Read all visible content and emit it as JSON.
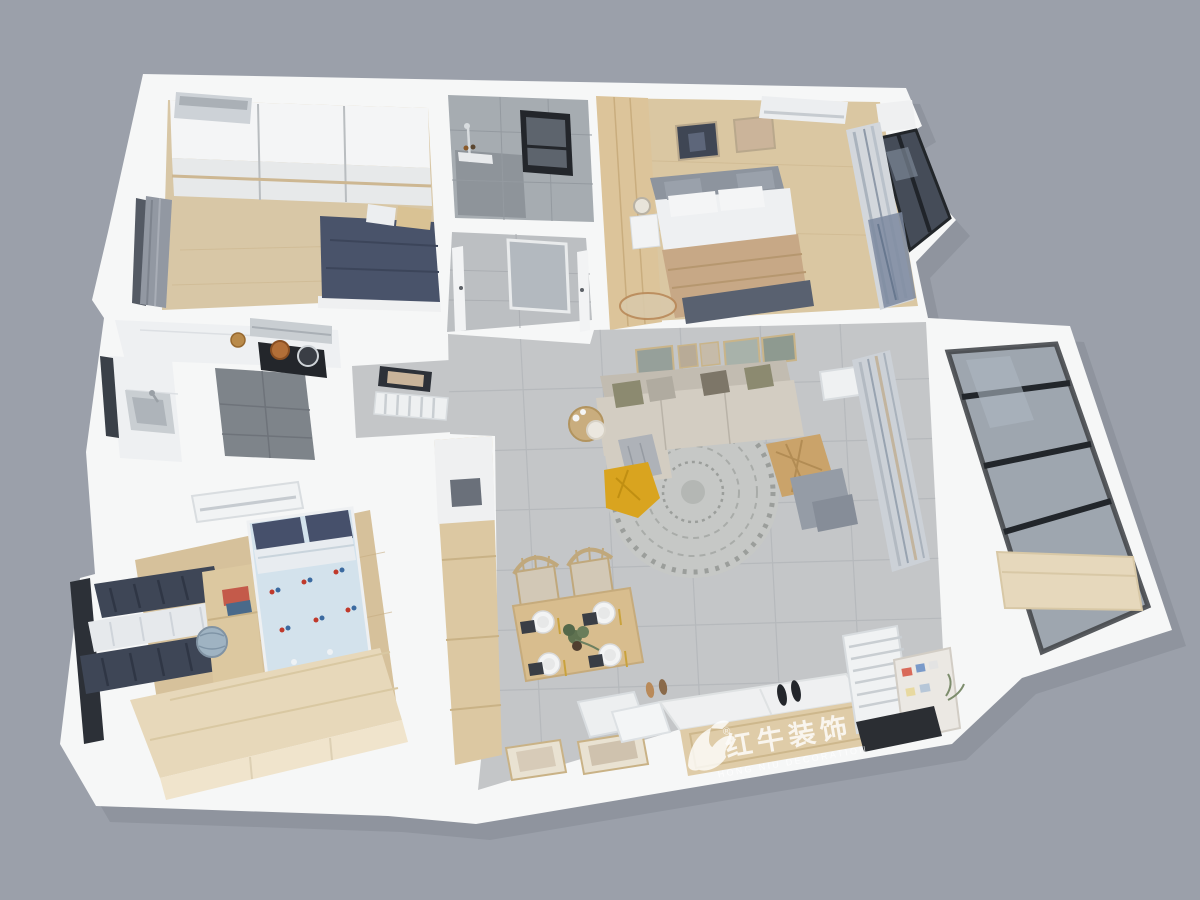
{
  "watermark": {
    "logo": "bull-logo-icon",
    "registered_mark": "®",
    "brand_cn": "红牛装饰",
    "brand_en": "HONG NIU DECORATION"
  },
  "scene": {
    "type": "3d-floor-plan-render",
    "view": "isometric-top-down-dollhouse",
    "rooms": [
      {
        "name": "secondary-bedroom",
        "position": "top-left",
        "items": [
          "sliding-wardrobe",
          "air-conditioner",
          "bed-navy-duvet",
          "gray-curtain-window"
        ]
      },
      {
        "name": "bathroom",
        "position": "top-center",
        "items": [
          "gray-wall-tiles",
          "shower-set",
          "black-framed-window"
        ]
      },
      {
        "name": "master-bedroom",
        "position": "top-right",
        "items": [
          "wood-wardrobe",
          "bed-beige-bedding",
          "two-wall-artworks",
          "air-conditioner",
          "nightstand-lamp",
          "striped-curtains",
          "corner-window"
        ]
      },
      {
        "name": "hallway",
        "position": "center-top",
        "items": [
          "frosted-glass-door",
          "white-interior-doors"
        ]
      },
      {
        "name": "kitchen",
        "position": "middle-left",
        "items": [
          "marble-counters",
          "range-hood",
          "gas-stove",
          "copper-pot",
          "sink",
          "side-window"
        ]
      },
      {
        "name": "living-dining-area",
        "position": "center",
        "items": [
          "fabric-sofa",
          "throw-pillows",
          "gallery-wall-frames",
          "round-mandala-rug",
          "yellow-beanbag",
          "rattan-armchair",
          "side-table-lamp",
          "air-conditioner",
          "striped-curtains",
          "dining-table-four-settings",
          "windsor-chairs",
          "plant-centerpiece"
        ]
      },
      {
        "name": "kids-bedroom",
        "position": "bottom-left",
        "items": [
          "bed-airplane-print-bedding",
          "navy-curtains",
          "study-desk",
          "globe",
          "books",
          "tatami-platform",
          "air-conditioner",
          "desk-chair"
        ]
      },
      {
        "name": "entry",
        "position": "bottom-center",
        "items": [
          "shoe-cabinet-with-brand-logo",
          "black-shoes",
          "radiator",
          "memo-board",
          "floor-picture-frames",
          "white-cushions",
          "dark-door-mat"
        ]
      },
      {
        "name": "balcony",
        "position": "right",
        "items": [
          "black-framed-glazing",
          "wood-storage-cabinet"
        ]
      }
    ]
  },
  "palette": {
    "background": "#9ba0aa",
    "walls": "#f6f7f7",
    "wood_floor": "#d8c7a6",
    "tile_floor": "#c4c6c8",
    "navy": "#49536a",
    "accent_yellow": "#d9a41f",
    "glass_frame": "#26292e",
    "wood_furniture": "#dcc9a4"
  }
}
